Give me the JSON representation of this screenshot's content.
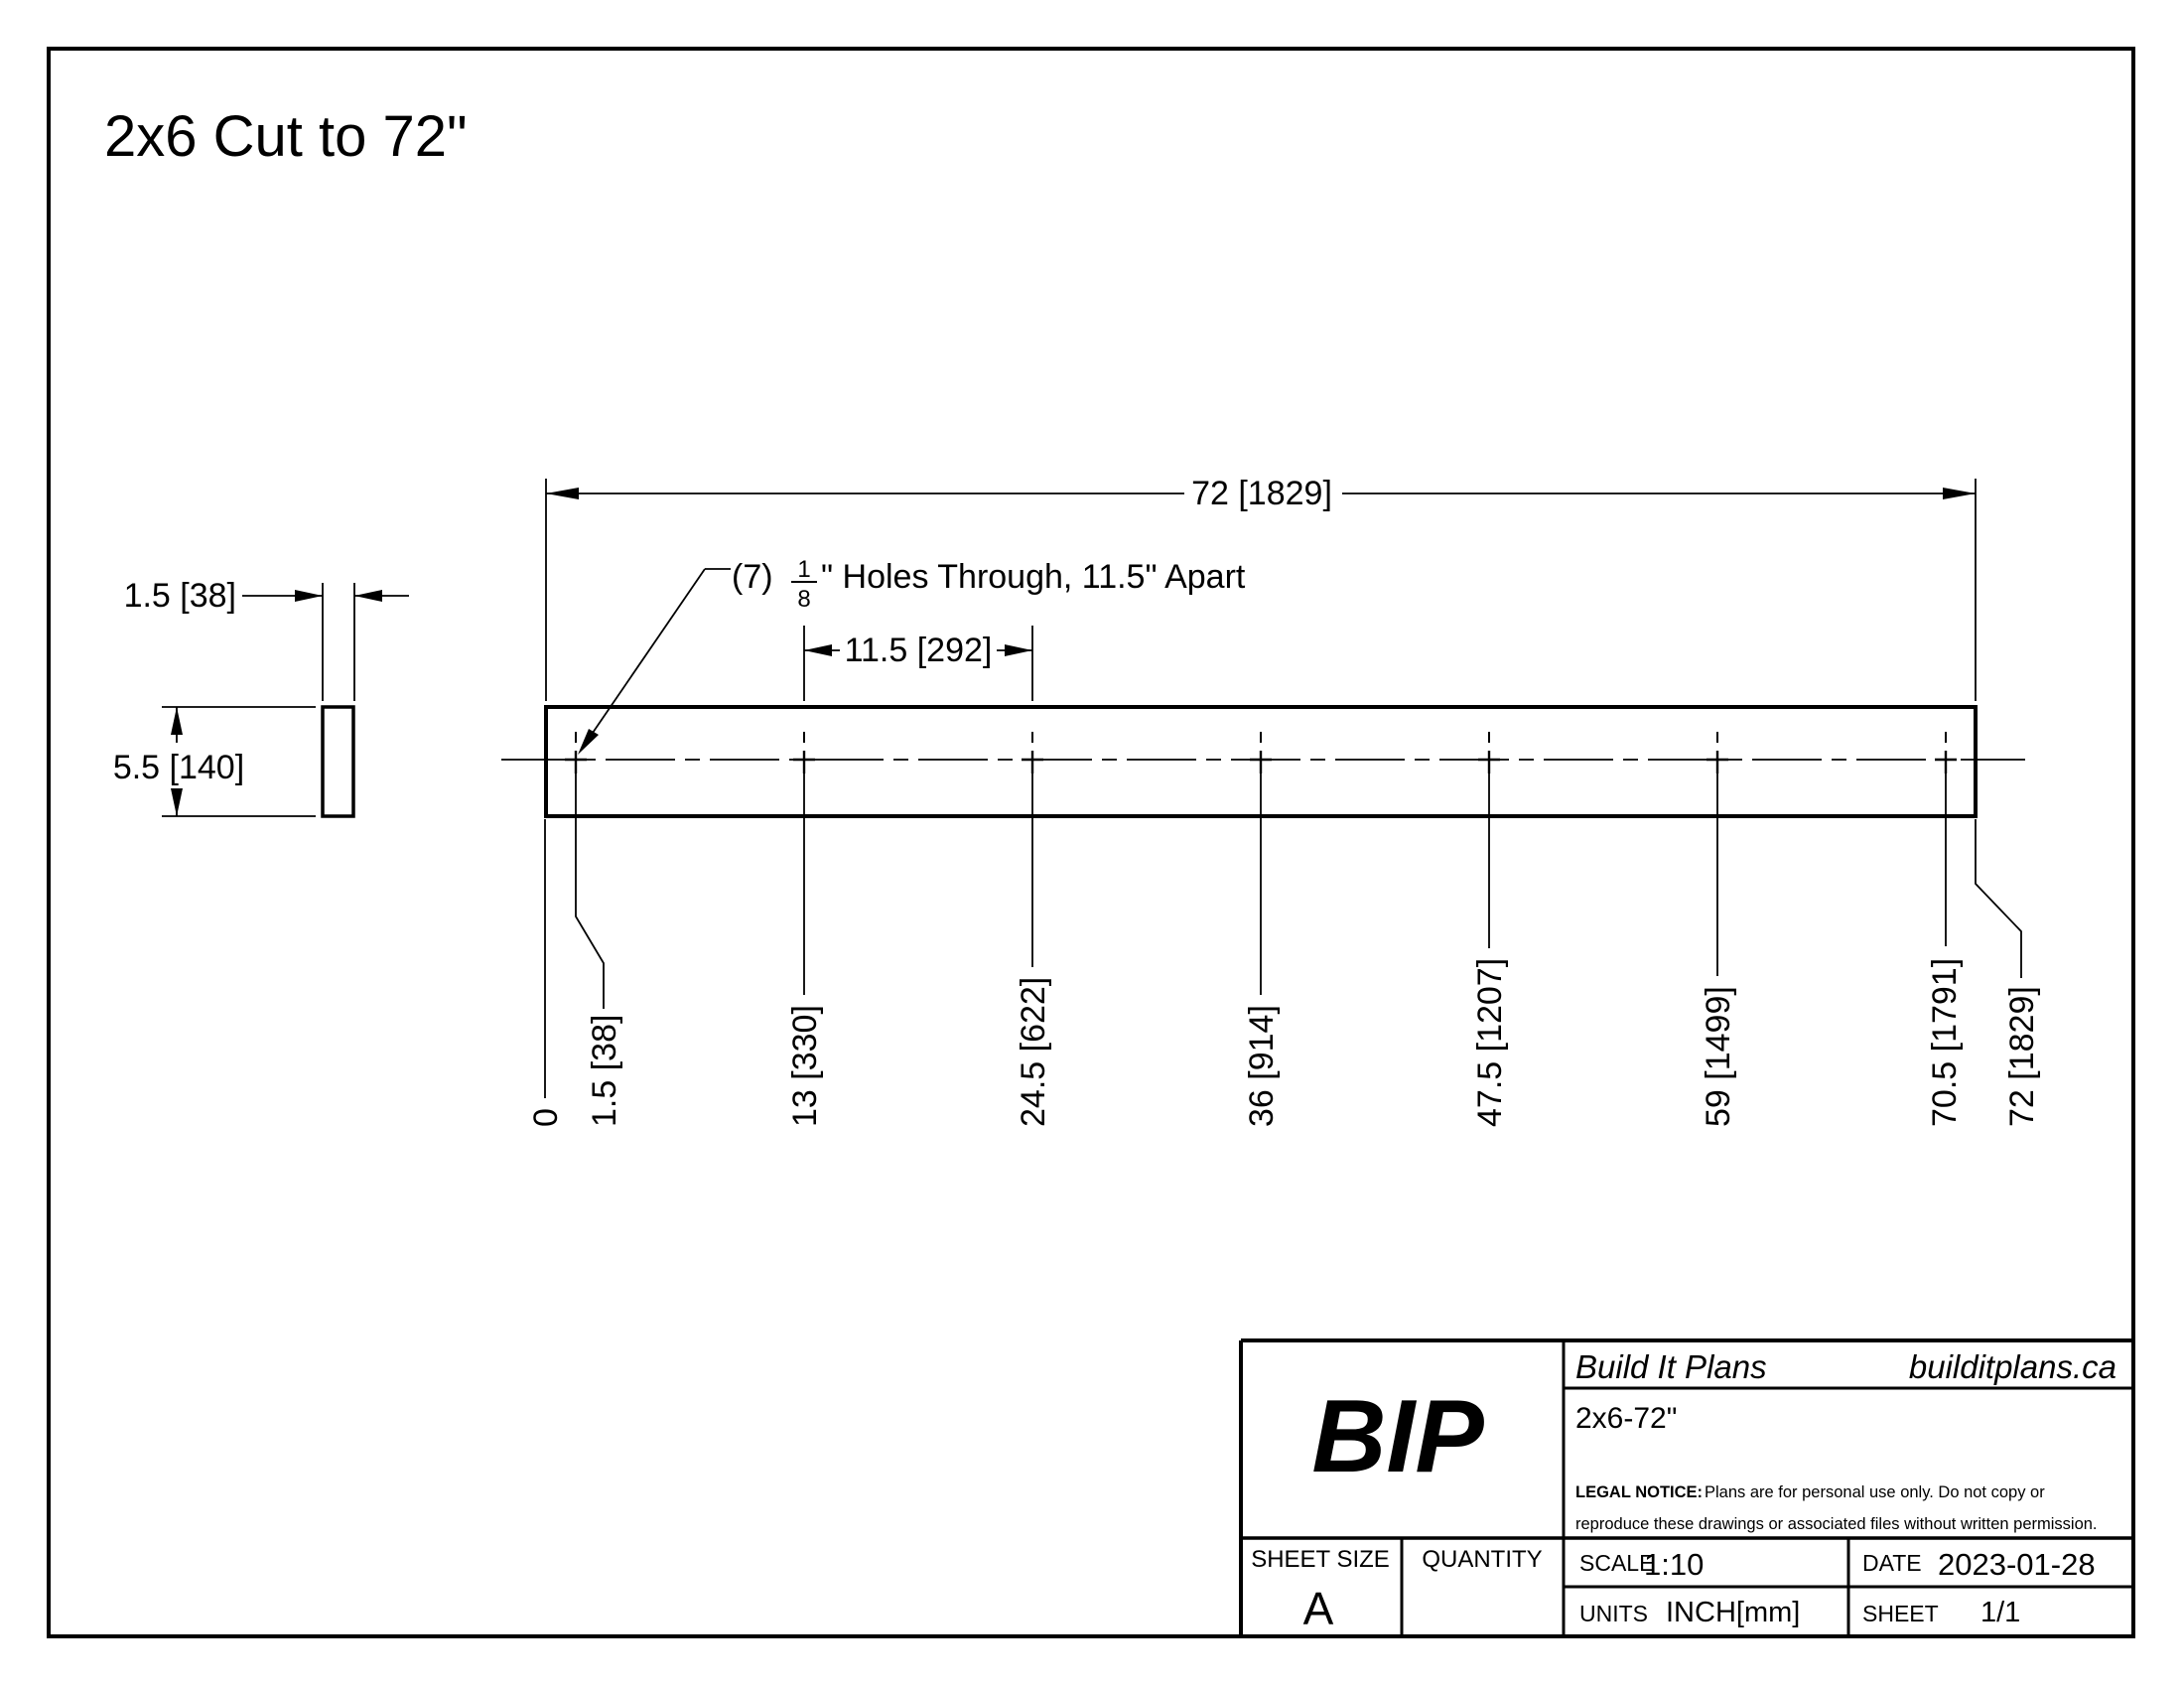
{
  "title": "2x6 Cut to 72\"",
  "colors": {
    "ink": "#000000",
    "paper": "#ffffff"
  },
  "side_view": {
    "width_dim": "1.5 [38]",
    "height_dim": "5.5 [140]"
  },
  "board": {
    "overall_dim": "72 [1829]",
    "spacing_dim": "11.5 [292]",
    "callout": {
      "prefix": "(7)",
      "frac_num": "1",
      "frac_den": "8",
      "suffix": "\" Holes Through, 11.5\" Apart"
    },
    "ordinates": [
      "0",
      "1.5 [38]",
      "13 [330]",
      "24.5 [622]",
      "36 [914]",
      "47.5 [1207]",
      "59 [1499]",
      "70.5 [1791]",
      "72 [1829]"
    ]
  },
  "title_block": {
    "logo": "BIP",
    "company": "Build It Plans",
    "website": "builditplans.ca",
    "part_name": "2x6-72\"",
    "legal_notice_label": "LEGAL NOTICE:",
    "legal_notice_line1": "Plans are for personal use only. Do not copy or",
    "legal_notice_line2": "reproduce these drawings or associated files without written permission.",
    "sheet_size_label": "SHEET SIZE",
    "sheet_size_value": "A",
    "quantity_label": "QUANTITY",
    "scale_label": "SCALE",
    "scale_value": "1:10",
    "units_label": "UNITS",
    "units_value": "INCH[mm]",
    "date_label": "DATE",
    "date_value": "2023-01-28",
    "sheet_label": "SHEET",
    "sheet_value": "1/1"
  }
}
